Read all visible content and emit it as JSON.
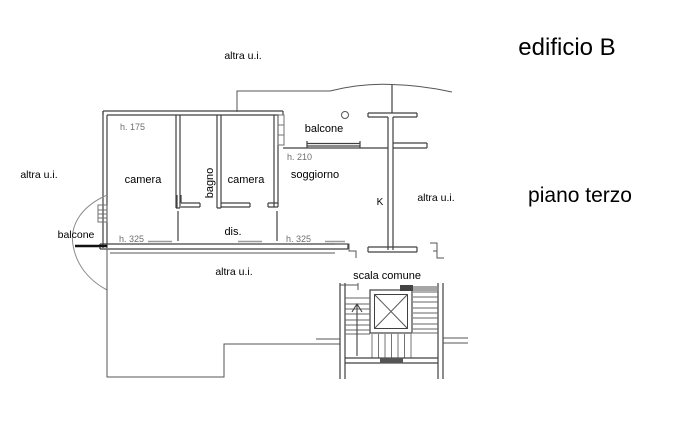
{
  "colors": {
    "background": "#ffffff",
    "wall": "#404040",
    "line": "#606060",
    "light_line": "#9a9a9a",
    "text": "#000000",
    "muted_text": "#6e6e6e"
  },
  "titles": {
    "building": "edificio B",
    "floor": "piano terzo"
  },
  "rooms": {
    "camera1": "camera",
    "bagno": "bagno",
    "camera2": "camera",
    "soggiorno": "soggiorno",
    "disimpegno": "dis.",
    "kitchen": "K",
    "balcone_top": "balcone",
    "balcone_left": "balcone",
    "scala": "scala comune"
  },
  "heights": {
    "camera1": "h. 175",
    "soggiorno": "h. 210",
    "dis_left": "h. 325",
    "dis_right": "h. 325"
  },
  "other_units": {
    "top": "altra u.i.",
    "left": "altra u.i.",
    "right": "altra u.i.",
    "bottom": "altra u.i."
  }
}
